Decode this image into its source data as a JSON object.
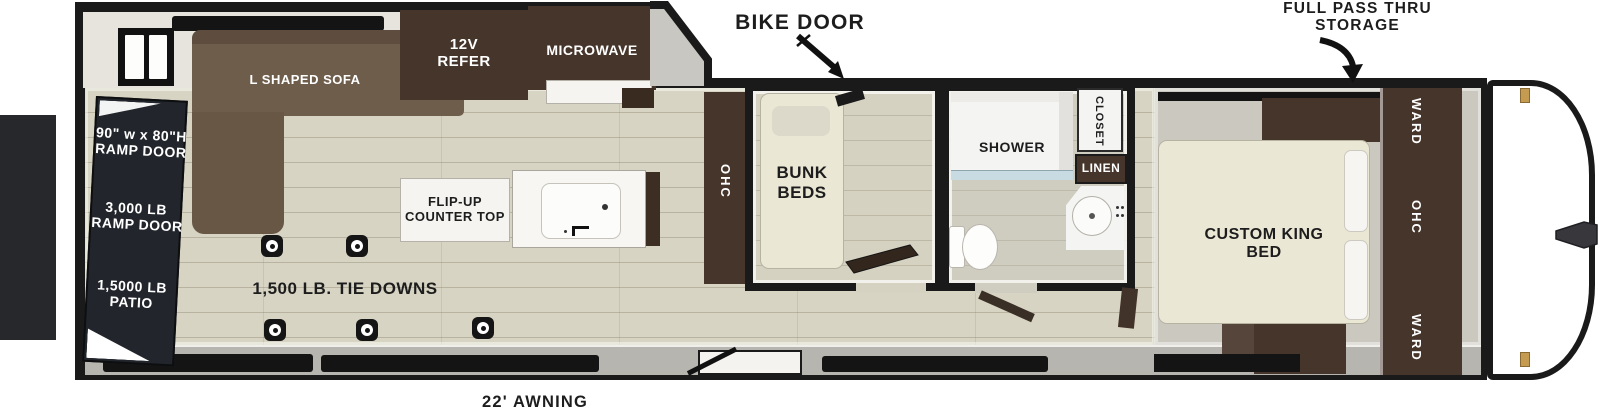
{
  "theme": {
    "outline": "#1a1a1a",
    "wall": "#e6e4dd",
    "floor_wood": "#d8d4c3",
    "floor_gray": "#cbc8c0",
    "cabinet_dark": "#46352a",
    "sofa_brown": "#6f5d4b",
    "cream": "#ebe7d5",
    "patio_dark": "#26282c",
    "ramp_panel": "#22262c",
    "band_gray": "#b7b5b0",
    "glass_blue": "#c9dbe2",
    "hinge_gold": "#c59b52",
    "label_dark": "#1d1d1d",
    "white": "#ffffff"
  },
  "callouts": {
    "bike_door": "BIKE DOOR",
    "full_pass_thru": [
      "FULL PASS THRU",
      "STORAGE"
    ],
    "awning": "22' AWNING"
  },
  "rear": {
    "ramp_size": [
      "90\" w x 80\"H",
      "RAMP DOOR"
    ],
    "ramp_weight": [
      "3,000 LB",
      "RAMP DOOR"
    ],
    "patio": [
      "1,5000 LB",
      "PATIO"
    ]
  },
  "garage": {
    "sofa": "L SHAPED SOFA",
    "refer": [
      "12V",
      "REFER"
    ],
    "microwave": "MICROWAVE",
    "flip_up_counter": [
      "FLIP-UP",
      "COUNTER TOP"
    ],
    "tie_downs": "1,500 LB. TIE DOWNS",
    "tie_down_count": 5,
    "ohc": "OHC"
  },
  "bunk_room": {
    "label": [
      "BUNK",
      "BEDS"
    ]
  },
  "bathroom": {
    "shower": "SHOWER",
    "closet": "CLOSET",
    "linen": "LINEN"
  },
  "bedroom": {
    "bed": [
      "CUSTOM KING",
      "BED"
    ],
    "ward_top": "WARD",
    "ohc": "OHC",
    "ward_bottom": "WARD"
  }
}
